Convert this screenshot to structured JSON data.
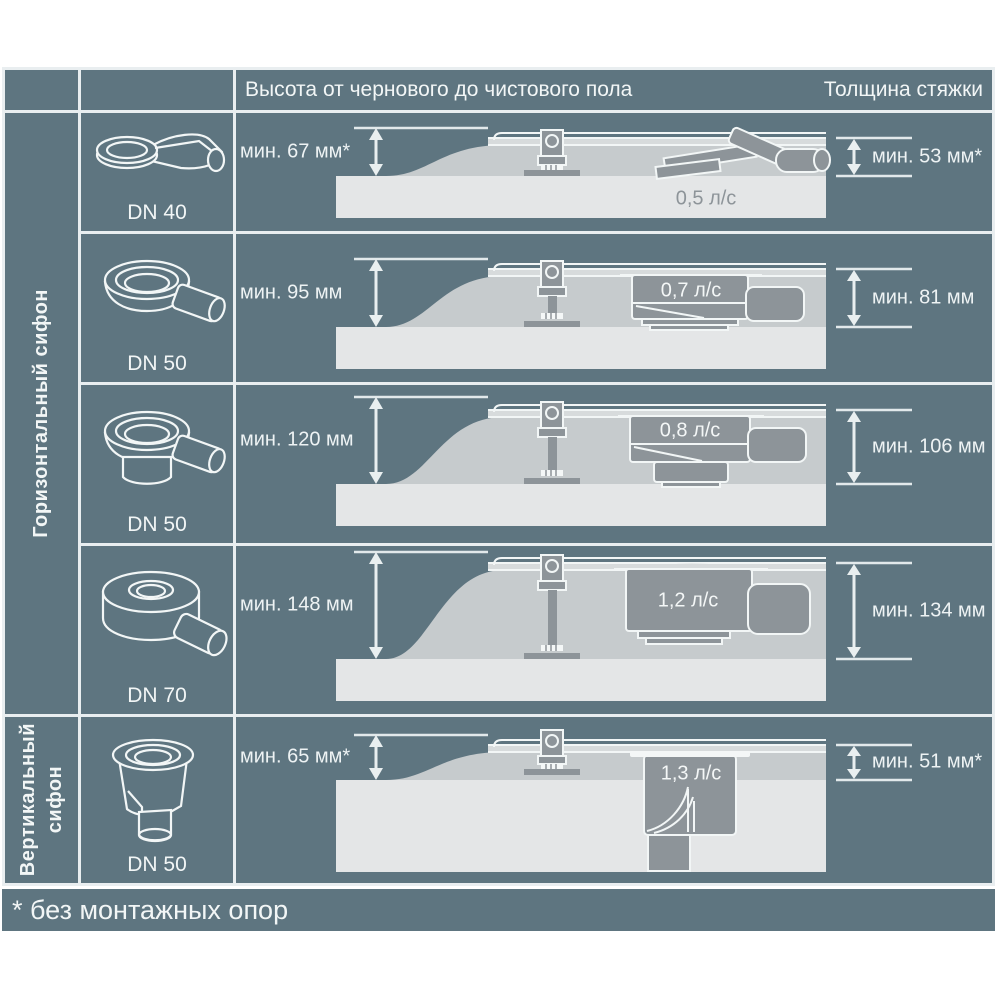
{
  "theme": {
    "page_bg": "#ffffff",
    "panel": "#5e7580",
    "border": "#e9eef0",
    "text": "#f2f6f6",
    "slab": "#e4e6e7",
    "screed": "#c6cbcd",
    "dark_gray": "#8d9499",
    "dim_line": "#e9eff0"
  },
  "header": {
    "height_label": "Высота от чернового до чистового пола",
    "screed_label": "Толщина стяжки"
  },
  "sections": {
    "horizontal_label": "Горизонтальный сифон",
    "vertical_label": "Вертикальный\nсифон"
  },
  "rows": [
    {
      "dn_label": "DN 40",
      "min_height": "мин. 67 мм*",
      "flow_rate": "0,5 л/с",
      "min_screed": "мин. 53 мм*"
    },
    {
      "dn_label": "DN 50",
      "min_height": "мин. 95 мм",
      "flow_rate": "0,7 л/с",
      "min_screed": "мин. 81 мм"
    },
    {
      "dn_label": "DN 50",
      "min_height": "мин. 120 мм",
      "flow_rate": "0,8 л/с",
      "min_screed": "мин. 106 мм"
    },
    {
      "dn_label": "DN 70",
      "min_height": "мин. 148 мм",
      "flow_rate": "1,2 л/с",
      "min_screed": "мин. 134 мм"
    },
    {
      "dn_label": "DN 50",
      "min_height": "мин. 65 мм*",
      "flow_rate": "1,3 л/с",
      "min_screed": "мин. 51 мм*"
    }
  ],
  "footnote": {
    "text": "* без монтажных опор"
  }
}
